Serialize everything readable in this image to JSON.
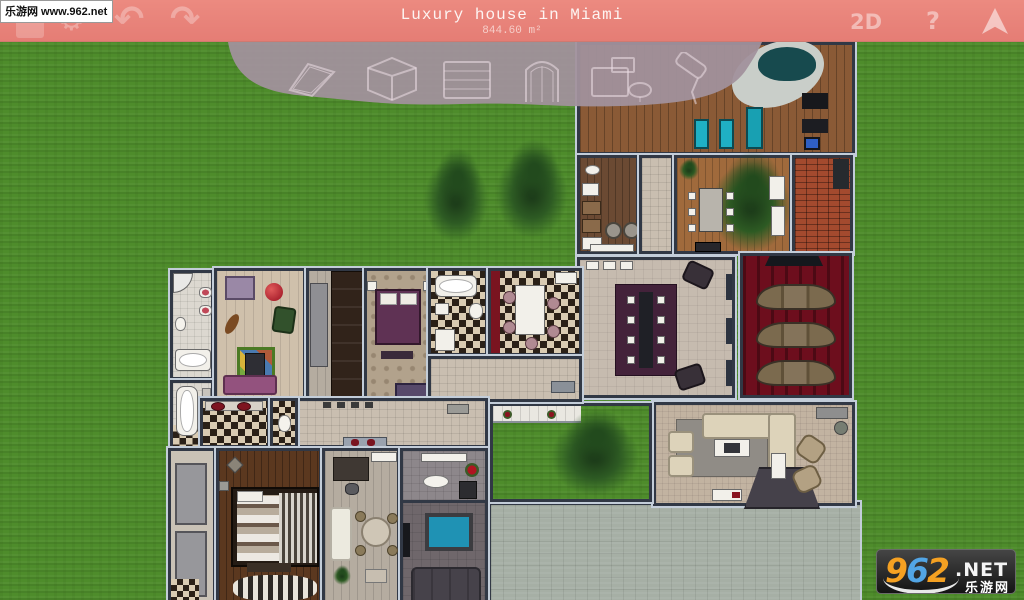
{
  "watermark": {
    "text": "乐游网 www.962.net"
  },
  "topbar": {
    "title": "Luxury house in Miami",
    "area": "844.60 m²",
    "view_label": "2D",
    "help_label": "?",
    "icons": {
      "settings": "⚙",
      "undo": "↶",
      "redo": "↷"
    }
  },
  "tray": {
    "tools": [
      "floor",
      "room",
      "wall",
      "door",
      "furniture",
      "paint"
    ]
  },
  "logo": {
    "digits": [
      "9",
      "6",
      "2"
    ],
    "net": ".NET",
    "site": "乐游网"
  },
  "colors": {
    "topbar_pink": "#e8837b",
    "tray_mauve": "#a2929c",
    "grass_green": "#4e8c2b",
    "logo_orange": "#f5a122",
    "logo_blue": "#52a5e5",
    "wall": "#313845",
    "theater_red": "#6d0e1d"
  }
}
